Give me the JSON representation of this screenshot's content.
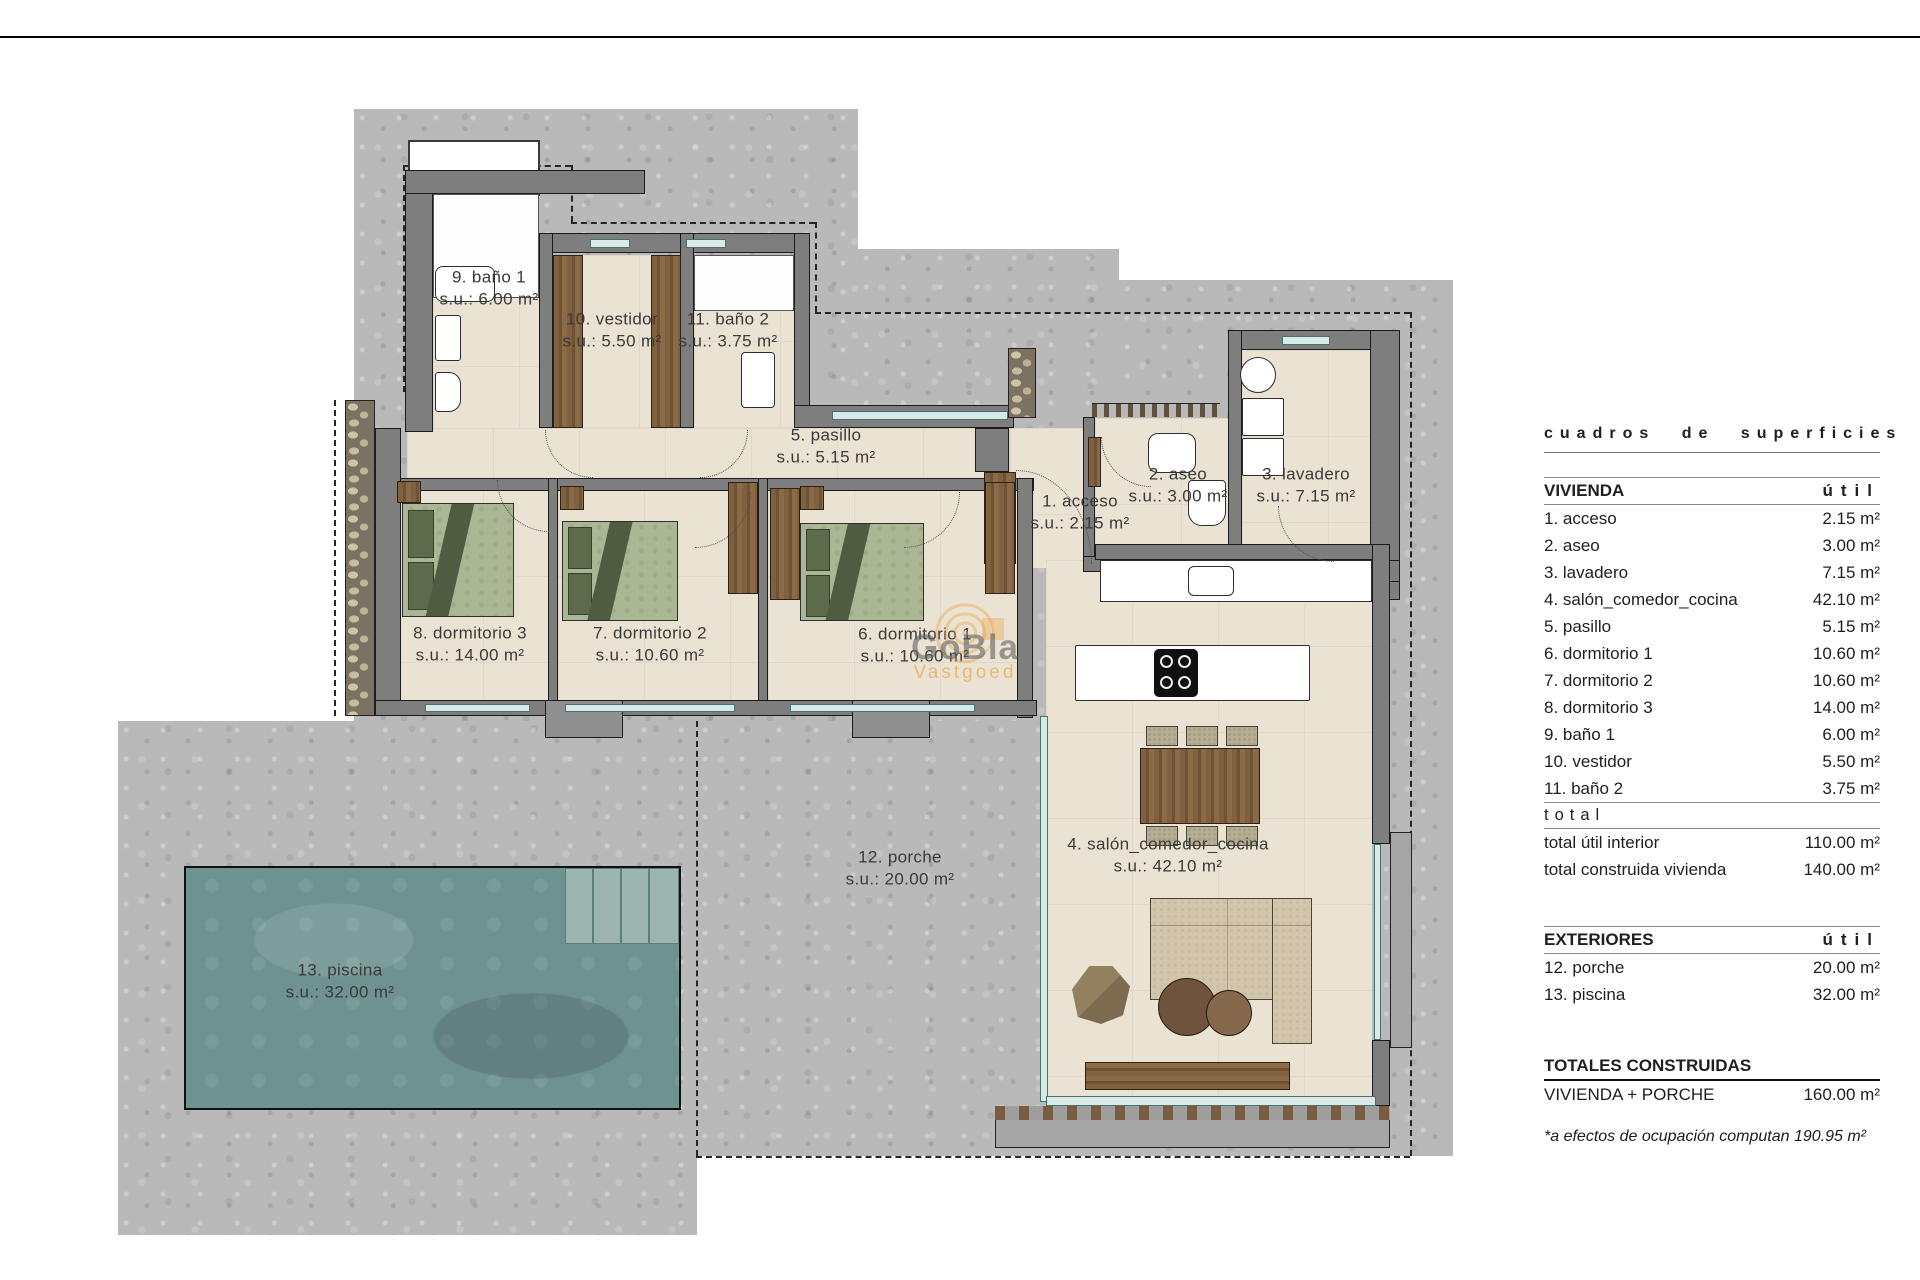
{
  "plan": {
    "rooms": [
      {
        "key": "acceso",
        "label": "1. acceso",
        "area": "s.u.: 2.15 m²"
      },
      {
        "key": "aseo",
        "label": "2. aseo",
        "area": "s.u.: 3.00 m²"
      },
      {
        "key": "lavadero",
        "label": "3. lavadero",
        "area": "s.u.: 7.15 m²"
      },
      {
        "key": "salon",
        "label": "4. salón_comedor_cocina",
        "area": "s.u.: 42.10 m²"
      },
      {
        "key": "pasillo",
        "label": "5. pasillo",
        "area": "s.u.: 5.15 m²"
      },
      {
        "key": "dormitorio1",
        "label": "6. dormitorio 1",
        "area": "s.u.: 10.60 m²"
      },
      {
        "key": "dormitorio2",
        "label": "7. dormitorio 2",
        "area": "s.u.: 10.60 m²"
      },
      {
        "key": "dormitorio3",
        "label": "8. dormitorio 3",
        "area": "s.u.: 14.00 m²"
      },
      {
        "key": "banio1",
        "label": "9. baño 1",
        "area": "s.u.: 6.00 m²"
      },
      {
        "key": "vestidor",
        "label": "10. vestidor",
        "area": "s.u.: 5.50 m²"
      },
      {
        "key": "banio2",
        "label": "11. baño 2",
        "area": "s.u.: 3.75 m²"
      },
      {
        "key": "porche",
        "label": "12. porche",
        "area": "s.u.: 20.00 m²"
      },
      {
        "key": "piscina",
        "label": "13. piscina",
        "area": "s.u.: 32.00 m²"
      }
    ],
    "watermark": {
      "brand": "GoBla",
      "sub": "Vastgoed"
    }
  },
  "sidebar": {
    "title": "cuadros de superficies",
    "vivienda": {
      "header": "VIVIENDA",
      "unit": "útil",
      "rows": [
        {
          "label": "1. acceso",
          "value": "2.15 m²"
        },
        {
          "label": "2. aseo",
          "value": "3.00 m²"
        },
        {
          "label": "3. lavadero",
          "value": "7.15 m²"
        },
        {
          "label": "4. salón_comedor_cocina",
          "value": "42.10 m²"
        },
        {
          "label": "5. pasillo",
          "value": "5.15 m²"
        },
        {
          "label": "6. dormitorio 1",
          "value": "10.60 m²"
        },
        {
          "label": "7. dormitorio 2",
          "value": "10.60 m²"
        },
        {
          "label": "8. dormitorio 3",
          "value": "14.00 m²"
        },
        {
          "label": "9. baño 1",
          "value": "6.00 m²"
        },
        {
          "label": "10. vestidor",
          "value": "5.50 m²"
        },
        {
          "label": "11. baño 2",
          "value": "3.75 m²"
        }
      ],
      "total_divider": "total",
      "totals": [
        {
          "label": "total útil interior",
          "value": "110.00 m²"
        },
        {
          "label": "total construida vivienda",
          "value": "140.00 m²"
        }
      ]
    },
    "exteriores": {
      "header": "EXTERIORES",
      "unit": "útil",
      "rows": [
        {
          "label": "12. porche",
          "value": "20.00 m²"
        },
        {
          "label": "13. piscina",
          "value": "32.00 m²"
        }
      ]
    },
    "totales": {
      "header": "TOTALES CONSTRUIDAS",
      "rows": [
        {
          "label": "VIVIENDA + PORCHE",
          "value": "160.00 m²"
        }
      ]
    },
    "footnote": "*a efectos de ocupación computan 190.95 m²"
  }
}
